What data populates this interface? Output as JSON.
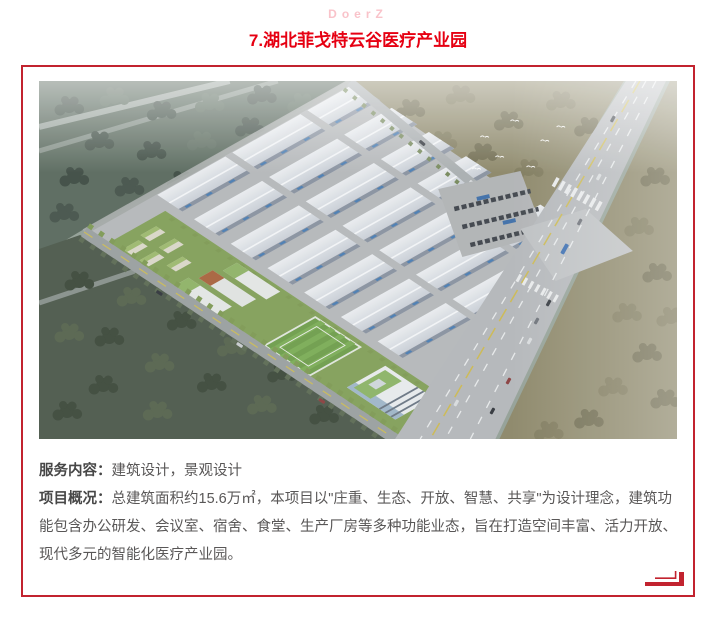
{
  "page": {
    "brand": "DoerZ",
    "title": "7.湖北菲戈特云谷医疗产业园"
  },
  "card": {
    "image_description": "湖北菲戈特云谷医疗产业园鸟瞰效果图：白色厂房群、绿色园区、足球场、高层塔楼、周边林地与城市道路",
    "service": {
      "label": "服务内容：",
      "text": "建筑设计，景观设计"
    },
    "overview": {
      "label": "项目概况：",
      "text": "总建筑面积约15.6万㎡，本项目以\"庄重、生态、开放、智慧、共享\"为设计理念，建筑功能包含办公研发、会议室、宿舍、食堂、生产厂房等多种功能业态，旨在打造空间丰富、活力开放、现代多元的智能化医疗产业园。"
    }
  },
  "colors": {
    "accent_red": "#e60012",
    "border_red": "#c2232f",
    "brand_pink": "#f9c3ca",
    "body_text": "#595757"
  }
}
